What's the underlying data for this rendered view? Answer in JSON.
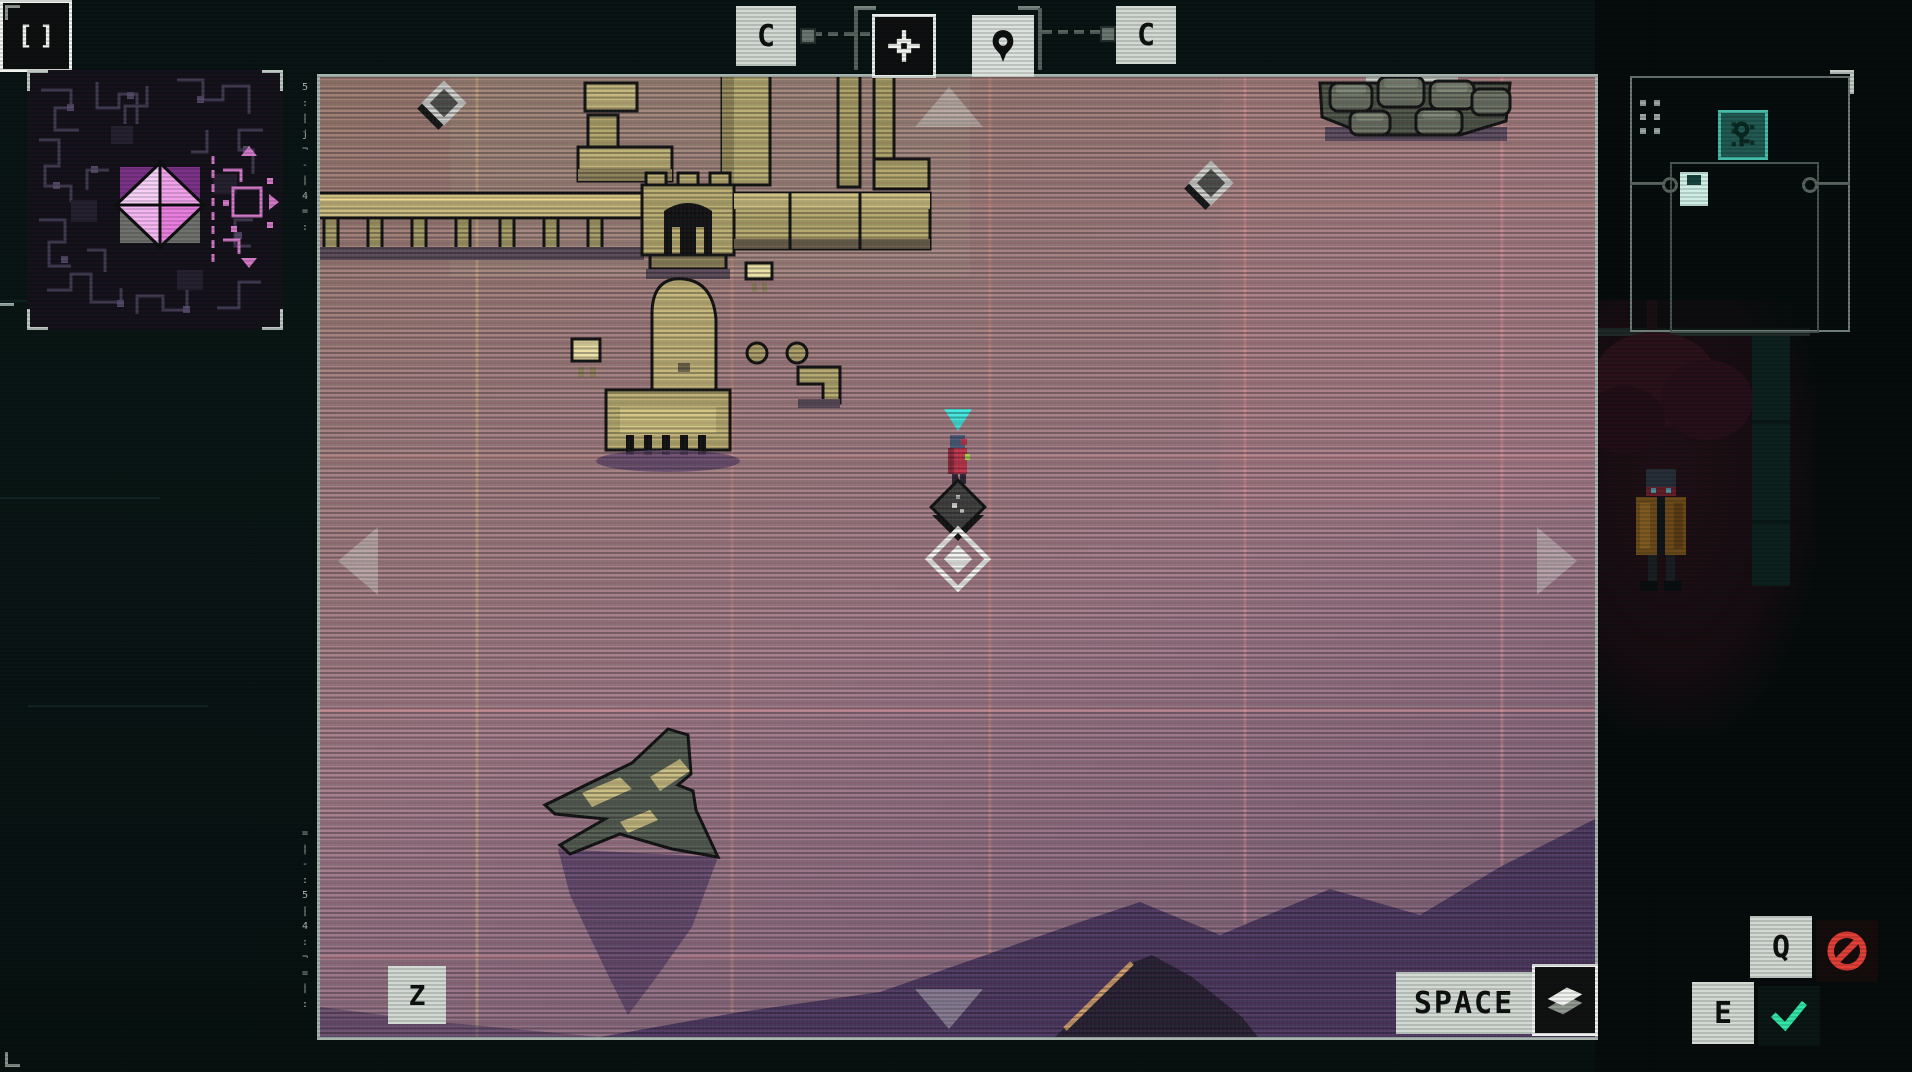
{
  "hud": {
    "cycle_left": {
      "label": "C"
    },
    "cycle_right": {
      "label": "C"
    },
    "zoom": {
      "key": "Z",
      "icon_glyph": "[]"
    },
    "layers": {
      "key": "SPACE"
    },
    "decline": {
      "key": "Q"
    },
    "accept": {
      "key": "E"
    }
  },
  "decor": {
    "glyph_column_top": "5\n:\n|\nj\n¬\n-\n|\n4\n=\n:",
    "glyph_column_bottom": "=\n|\n-\n:\n5\n|\n4\n:\n¬\n=\n|\n:",
    "panel_side_glyphs": "E\n|\n¬\n:\n4\n-\n|\n="
  },
  "icons": {
    "crosshair": "crosshair-icon",
    "pin": "map-pin-icon",
    "brackets": "zoom-brackets-icon",
    "layers": "map-layers-icon",
    "decline": "prohibition-icon",
    "accept": "checkmark-icon",
    "key_item": "key-item-icon",
    "floppy": "module-chip-icon"
  },
  "colors": {
    "map_base": "#a27d83",
    "map_grid": "#d89a84",
    "terrain_khaki": "#bfb173",
    "dark_zone": "#46305a",
    "player_marker_cyan": "#3fe8de",
    "player_body_red": "#c13048",
    "accent_red": "#e23c34",
    "accent_green": "#2fe6a6",
    "hud_plate": "#d3d8d2",
    "emblem_pink": "#f2a0ea",
    "emblem_purple": "#7c2e86",
    "panel_teal": "#43baa8"
  }
}
